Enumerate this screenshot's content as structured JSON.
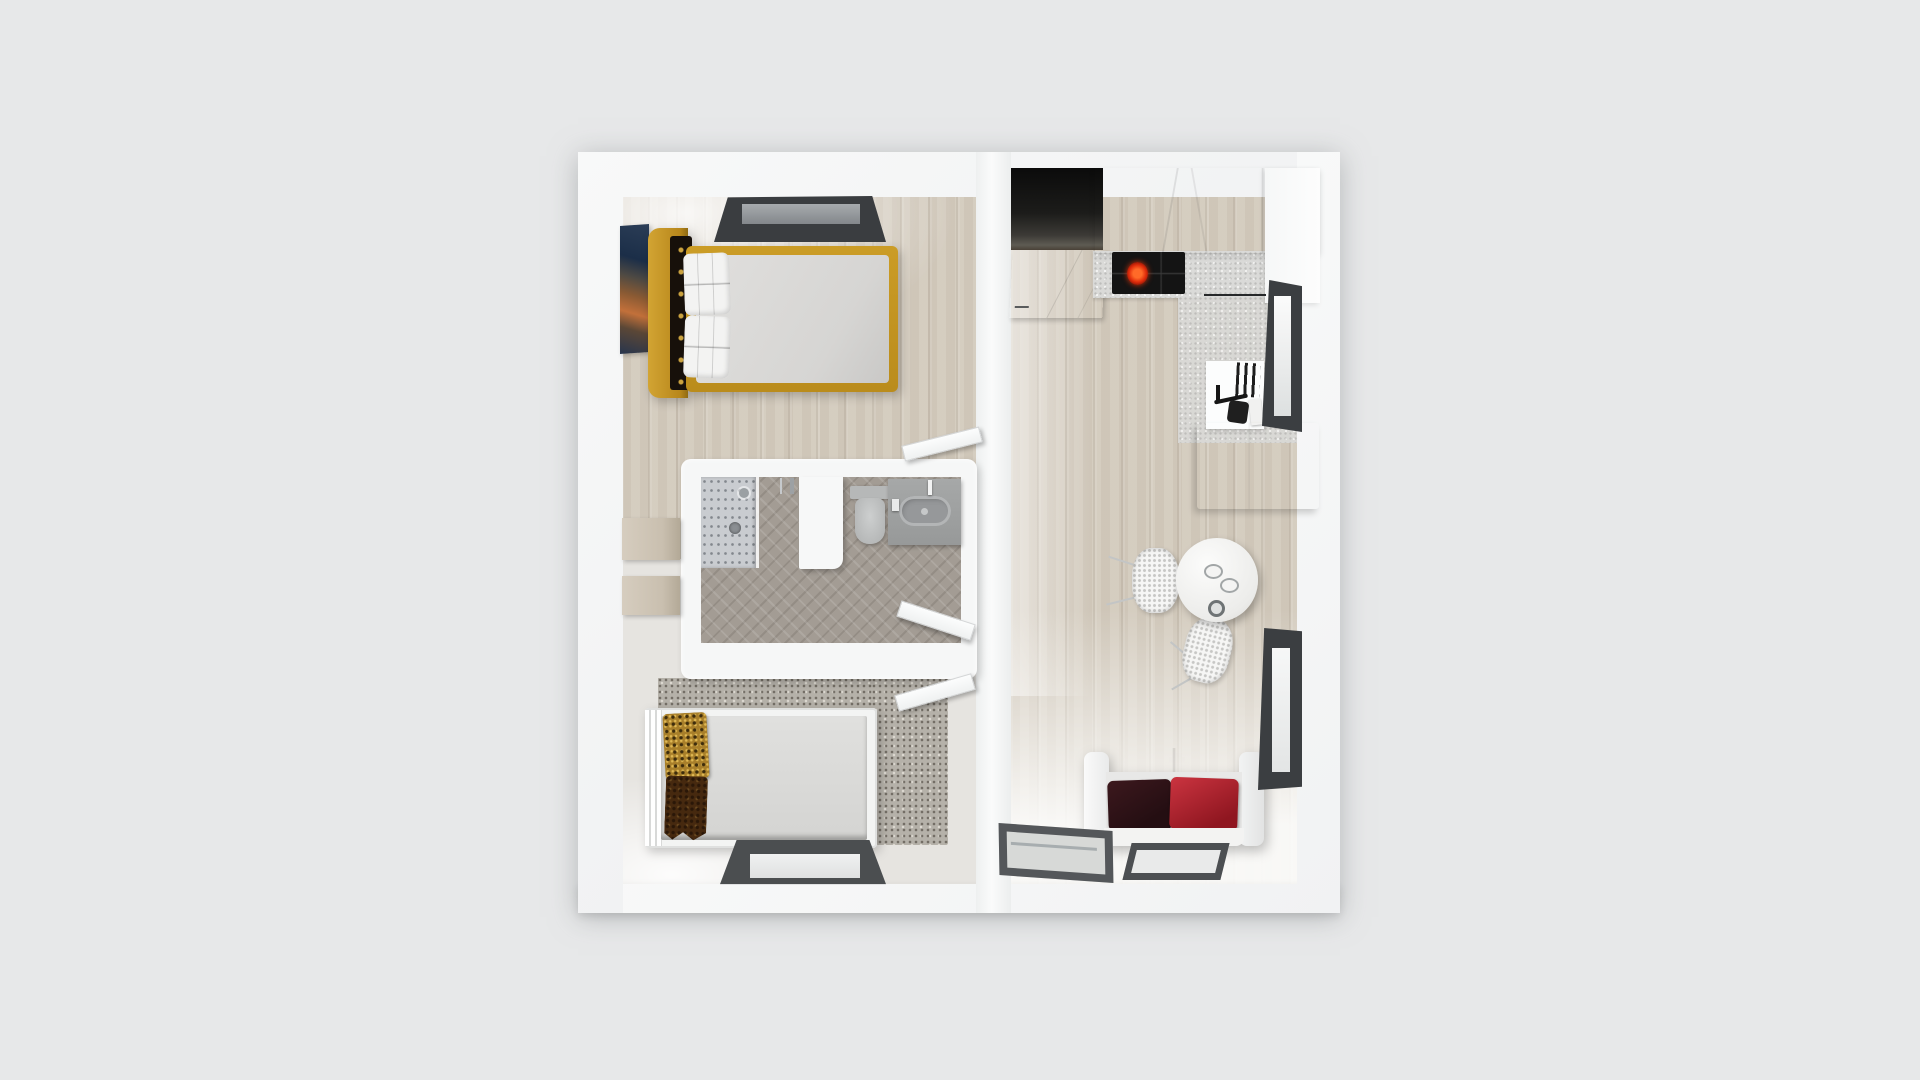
{
  "scene": {
    "type": "3d-floorplan-top-down-render",
    "description": "Top-down 3D render of a small one-bedroom apartment floor plan centered on a plain light gray background. No text labels are visible.",
    "background_color": "#e7e8e9",
    "view": "bird's-eye"
  },
  "palette": {
    "outer_wall": "#f1f2f3",
    "inner_wall": "#f7f8f8",
    "wood_floor": "#d4ccbf",
    "bathroom_herringbone": "#a39c94",
    "shower_tile": "#c9ccd0",
    "terrazzo_rug": "#b5b1a9",
    "bed_frame_mustard": "#ba8c1c",
    "headboard_tufted_dark": "#17100a",
    "mattress_gray": "#dad9d7",
    "wardrobe_tan": "#c9bfaf",
    "sofa_white": "#f2f2f1",
    "cushion_maroon": "#2e1216",
    "cushion_red": "#b22730",
    "pillow_gold_pattern": "#a87f2a",
    "pillow_brown_pattern": "#46290f",
    "cooktop_black": "#141414",
    "burner_glow_red": "#e02c0b",
    "window_frame_dark": "#3b3e41",
    "entry_alcove_shadow": "#0b0b0b",
    "door_white": "#fcfdfd"
  },
  "rooms": {
    "bedroom_main": {
      "label": "Main bedroom (top left)",
      "items": [
        "double bed with mustard frame and dark tufted headboard",
        "two white quilted pillows",
        "abstract wall art",
        "tan wardrobe",
        "dark-framed window in top wall",
        "light wood plank floor"
      ]
    },
    "bathroom": {
      "label": "Bathroom (center left)",
      "items": [
        "corner shower with speckled tile",
        "toilet",
        "gray vanity with oval basin",
        "white partition wall",
        "gray herringbone tile floor",
        "open white door"
      ]
    },
    "bedroom_second": {
      "label": "Second bedroom (bottom left)",
      "items": [
        "white single bed",
        "gold patterned pillow",
        "brown patterned pillow",
        "tan wardrobe",
        "terrazzo rug area",
        "dark-framed window in bottom wall",
        "open white door"
      ]
    },
    "living_kitchen": {
      "label": "Open living room and kitchen (right)",
      "items": [
        "dark entry alcove",
        "white hall cabinet",
        "white kitchen upper cabinets",
        "speckled countertop",
        "black cooktop with one glowing red burner",
        "sink unit with dish rack and black faucet",
        "white island cabinet",
        "round white dining table with two plates and a glass",
        "two white wicker chairs",
        "white two-seat sofa with maroon and red cushions",
        "two dark-framed glass floor panels",
        "two dark-framed windows in right wall",
        "wood plank floor"
      ]
    }
  },
  "counts": {
    "windows": 4,
    "open_doors": 3,
    "beds": 2,
    "chairs": 2,
    "sofas": 1
  }
}
